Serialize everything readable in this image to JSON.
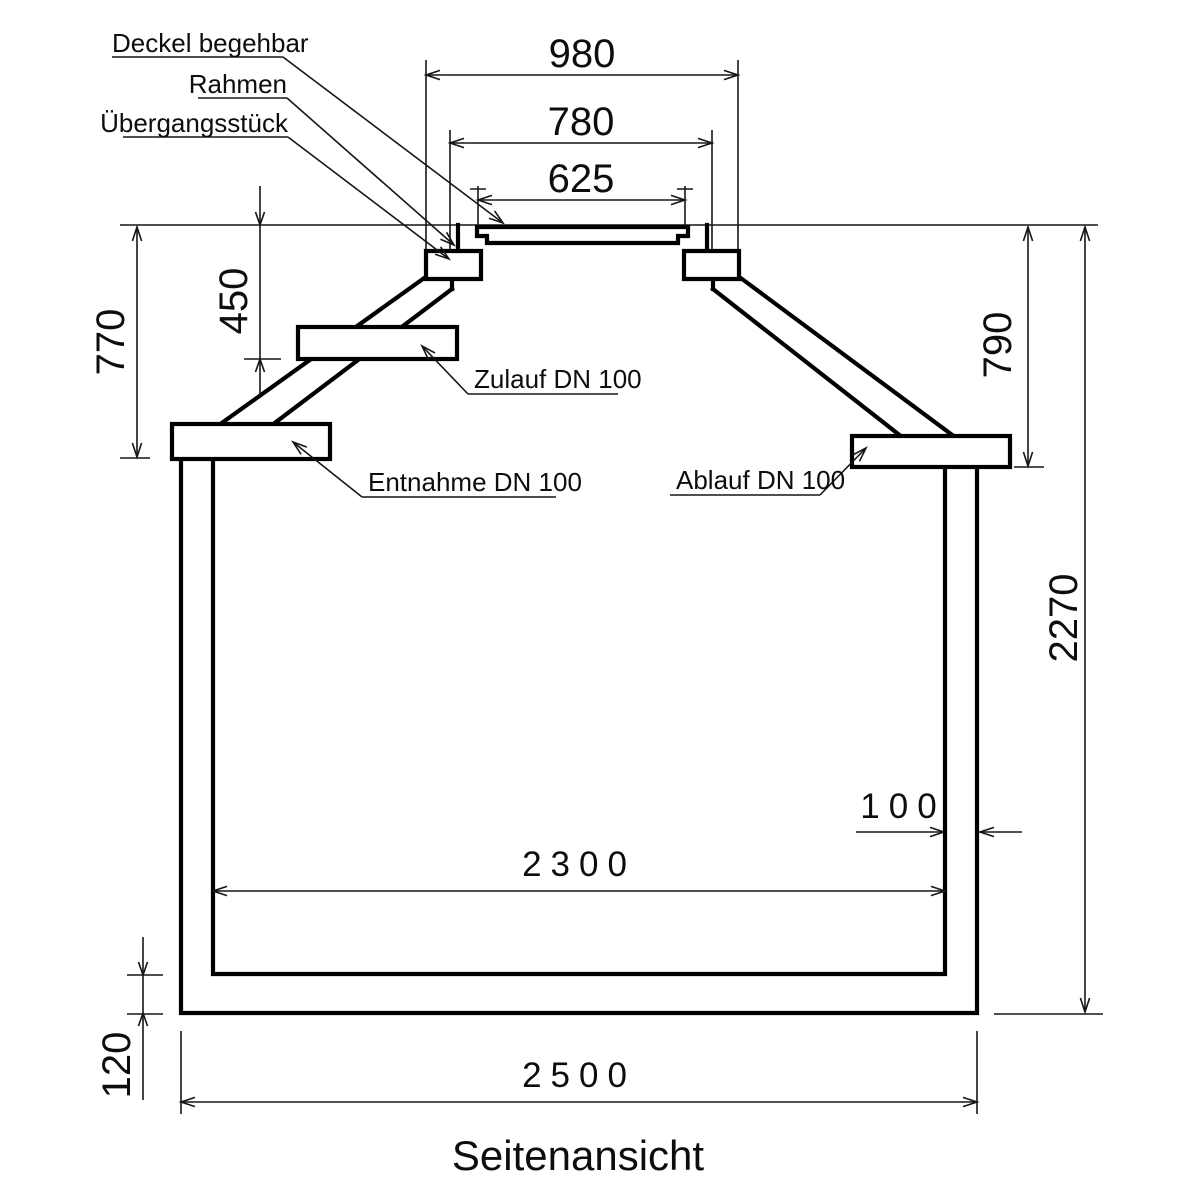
{
  "title": "Seitenansicht",
  "callouts": {
    "deckel": "Deckel begehbar",
    "rahmen": "Rahmen",
    "uebergangsstueck": "Übergangsstück",
    "zulauf": "Zulauf DN 100",
    "entnahme": "Entnahme DN 100",
    "ablauf": "Ablauf DN 100"
  },
  "dimensions": {
    "neck_outer_width": "980",
    "frame_width": "780",
    "lid_width": "625",
    "entnahme_depth": "770",
    "zulauf_depth": "450",
    "ablauf_depth": "790",
    "total_height": "2270",
    "wall_thickness": "100",
    "inner_width": "2300",
    "floor_thickness": "120",
    "outer_width": "2500"
  },
  "colors": {
    "line": "#000000",
    "background": "#ffffff"
  }
}
